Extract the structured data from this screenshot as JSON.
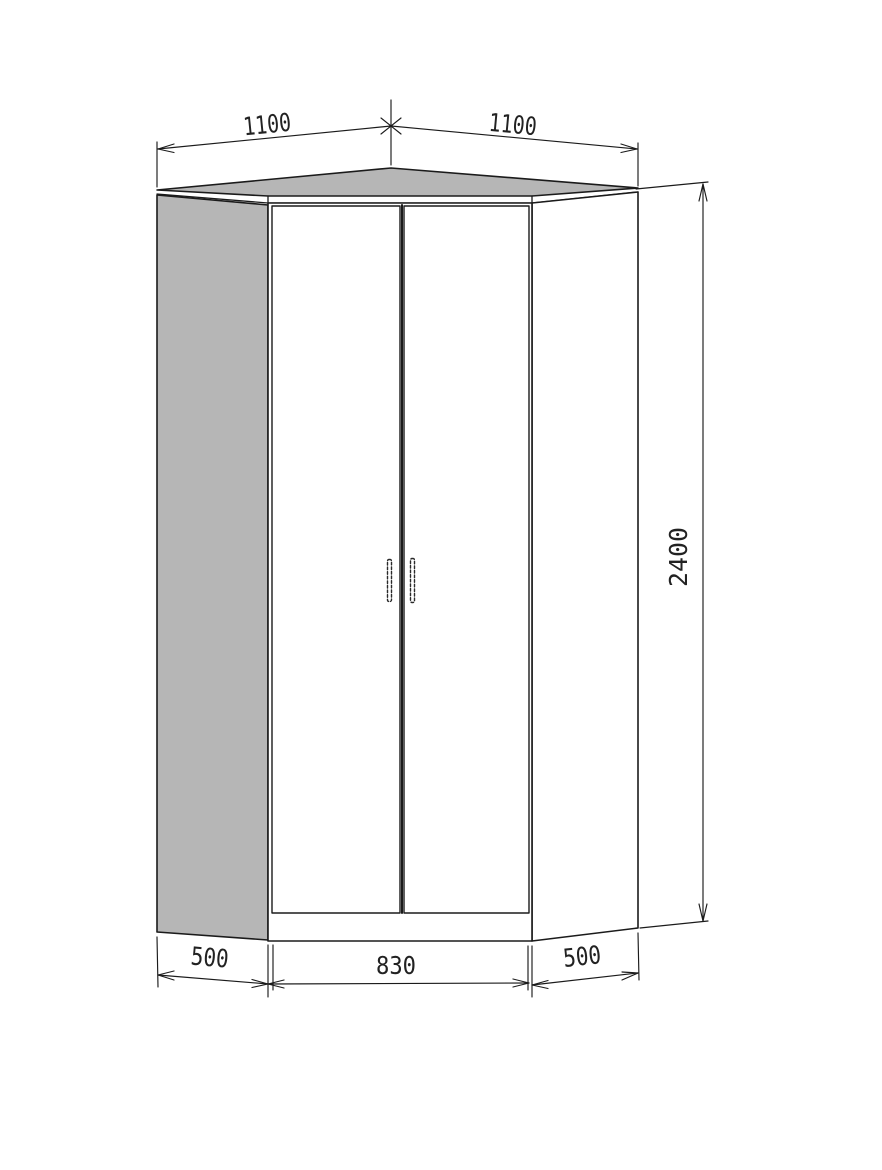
{
  "drawing": {
    "subject": "corner-wardrobe-technical-drawing",
    "dimensions": {
      "top_left_width": "1100",
      "top_right_width": "1100",
      "height": "2400",
      "left_depth": "500",
      "front_width": "830",
      "right_depth": "500"
    },
    "colors": {
      "panel_gray": "#b6b6b6",
      "line": "#1b1b1b",
      "background": "#ffffff"
    }
  }
}
